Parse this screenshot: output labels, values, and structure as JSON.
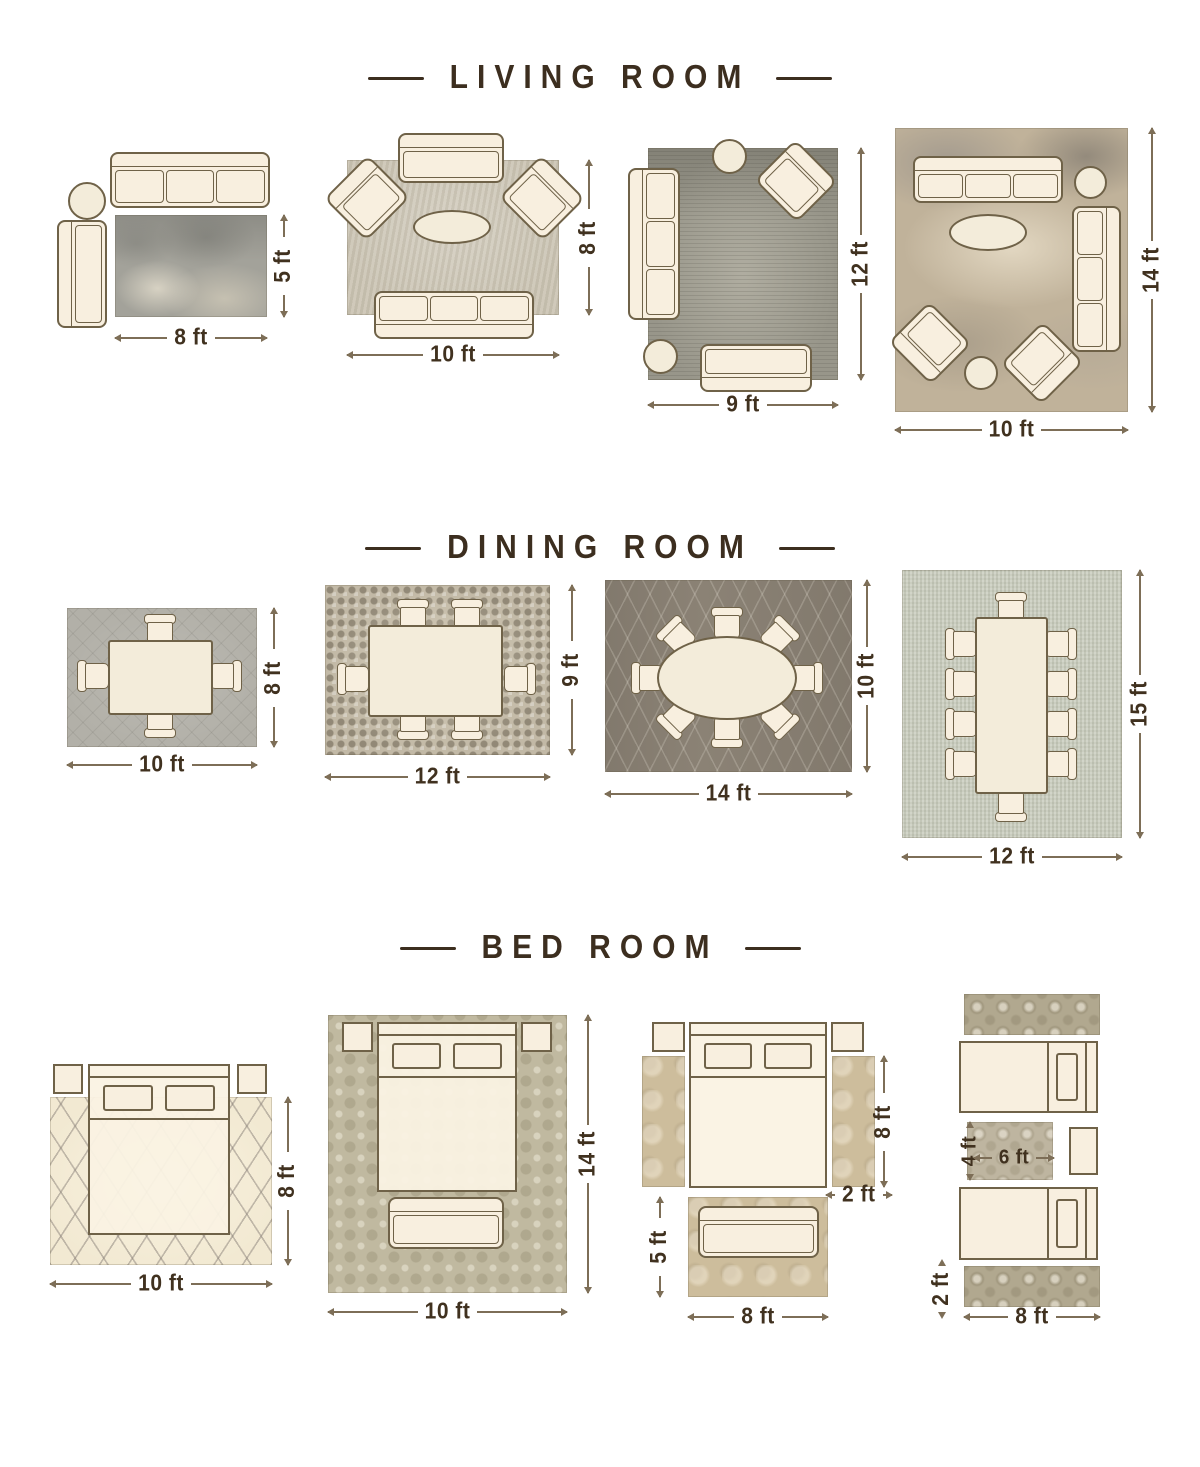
{
  "colors": {
    "background": "#ffffff",
    "title_text": "#3c2e1f",
    "dimension_text": "#40311f",
    "dimension_line": "#7d6e57",
    "furniture_fill": "#f8efdf",
    "furniture_outline": "#6f6248"
  },
  "sections": [
    {
      "title": "LIVING ROOM",
      "layouts": [
        {
          "name": "living-room-5x8",
          "width_label": "8 ft",
          "height_label": "5 ft"
        },
        {
          "name": "living-room-8x10",
          "width_label": "10 ft",
          "height_label": "8 ft"
        },
        {
          "name": "living-room-9x12",
          "width_label": "9 ft",
          "height_label": "12 ft"
        },
        {
          "name": "living-room-10x14",
          "width_label": "10 ft",
          "height_label": "14 ft"
        }
      ]
    },
    {
      "title": "DINING ROOM",
      "layouts": [
        {
          "name": "dining-room-8x10",
          "width_label": "10 ft",
          "height_label": "8 ft"
        },
        {
          "name": "dining-room-9x12",
          "width_label": "12 ft",
          "height_label": "9 ft"
        },
        {
          "name": "dining-room-10x14",
          "width_label": "14 ft",
          "height_label": "10 ft"
        },
        {
          "name": "dining-room-12x15",
          "width_label": "12 ft",
          "height_label": "15 ft"
        }
      ]
    },
    {
      "title": "BED ROOM",
      "layouts": [
        {
          "name": "bedroom-8x10",
          "width_label": "10 ft",
          "height_label": "8 ft"
        },
        {
          "name": "bedroom-10x14",
          "width_label": "10 ft",
          "height_label": "14 ft"
        },
        {
          "name": "bedroom-runners",
          "side_runner_length_label": "8 ft",
          "side_runner_width_label": "2 ft",
          "foot_rug_height_label": "5 ft",
          "foot_rug_width_label": "8 ft"
        },
        {
          "name": "bedroom-twin",
          "accent_rug_height_label": "4 ft",
          "accent_rug_width_label": "6 ft",
          "runner_height_label": "2 ft",
          "runner_width_label": "8 ft"
        }
      ]
    }
  ]
}
